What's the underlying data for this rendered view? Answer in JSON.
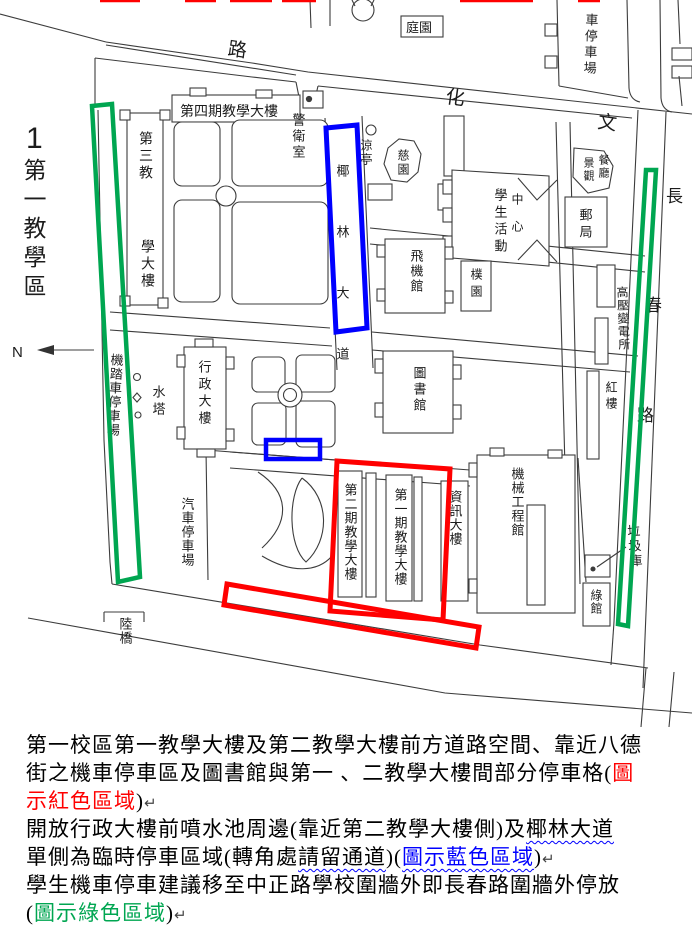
{
  "colors": {
    "overlay_red": "#ff0000",
    "overlay_blue": "#0000ff",
    "overlay_green": "#00a651",
    "map_line": "#3c3c3c",
    "note_red": "#ff0000",
    "note_blue": "#0000ff",
    "note_green": "#00a651"
  },
  "map": {
    "labels": [
      {
        "id": "area-number",
        "text": "1"
      },
      {
        "id": "area-name",
        "text": "第一教學區"
      },
      {
        "id": "north",
        "text": "N"
      },
      {
        "id": "road-wenhua-lu",
        "text": "路"
      },
      {
        "id": "road-wenhua-hua",
        "text": "化"
      },
      {
        "id": "road-wenhua-wen",
        "text": "文"
      },
      {
        "id": "road-changchun-chang",
        "text": "長"
      },
      {
        "id": "road-changchun-chun",
        "text": "春"
      },
      {
        "id": "road-changchun-lu",
        "text": "路"
      },
      {
        "id": "garden-court",
        "text": "庭園"
      },
      {
        "id": "parking-northeast",
        "text": "車停車場"
      },
      {
        "id": "teaching-bldg-4",
        "text": "第四期教學大樓"
      },
      {
        "id": "guard-room",
        "text": "警衛室"
      },
      {
        "id": "teaching-bldg-3-upper",
        "text": "第三教"
      },
      {
        "id": "teaching-bldg-3-lower",
        "text": "學大樓"
      },
      {
        "id": "pavilion",
        "text": "涼亭"
      },
      {
        "id": "ci-garden",
        "text": "慈園"
      },
      {
        "id": "yehlin-boulevard",
        "text": "椰林大道"
      },
      {
        "id": "student-activity",
        "text": "學生活動"
      },
      {
        "id": "center",
        "text": "中心"
      },
      {
        "id": "landscape",
        "text": "景觀"
      },
      {
        "id": "restaurant",
        "text": "餐廳"
      },
      {
        "id": "post-office",
        "text": "郵局"
      },
      {
        "id": "aviation-hall",
        "text": "飛機館"
      },
      {
        "id": "pu-garden",
        "text": "樸園"
      },
      {
        "id": "library",
        "text": "圖書館"
      },
      {
        "id": "hv-substation",
        "text": "高壓變電所"
      },
      {
        "id": "red-building",
        "text": "紅樓"
      },
      {
        "id": "admin-building",
        "text": "行政大樓"
      },
      {
        "id": "water-tower",
        "text": "水塔"
      },
      {
        "id": "motorcycle-parking",
        "text": "機踏車停車場"
      },
      {
        "id": "car-parking",
        "text": "汽車停車場"
      },
      {
        "id": "teaching-bldg-2",
        "text": "第二期教學大樓"
      },
      {
        "id": "teaching-bldg-1",
        "text": "第一期教學大樓"
      },
      {
        "id": "info-building",
        "text": "資訊大樓"
      },
      {
        "id": "mech-eng-hall",
        "text": "機械工程館"
      },
      {
        "id": "garbage-depot",
        "text": "垃圾庫"
      },
      {
        "id": "green-hall",
        "text": "綠館"
      },
      {
        "id": "overpass",
        "text": "陸橋"
      }
    ]
  },
  "notes": {
    "lines": [
      {
        "segments": [
          {
            "t": "第一校區第一教學大樓及第二教學大樓前方道路空間、靠近八德"
          }
        ]
      },
      {
        "segments": [
          {
            "t": "街之機車停車區及圖書館與第一 、二教學大樓間部分停車格("
          },
          {
            "t": "圖"
          }
        ]
      },
      {
        "segments": [
          {
            "t": "示紅色區域"
          },
          {
            "t": ")"
          },
          {
            "t": "↵"
          }
        ]
      },
      {
        "segments": [
          {
            "t": "開放行政大樓前噴水池周邊(靠近第二教學大樓側)及"
          },
          {
            "t": "椰林大道"
          }
        ]
      },
      {
        "segments": [
          {
            "t": "單側為臨時停車區域(轉角處"
          },
          {
            "t": "請留通道"
          },
          {
            "t": ")("
          },
          {
            "t": "圖示藍色區域"
          },
          {
            "t": ")"
          },
          {
            "t": "↵"
          }
        ]
      },
      {
        "segments": [
          {
            "t": "學生機車停車建議移至中正路學校圍牆外即長春路圍牆外停放"
          }
        ]
      },
      {
        "segments": [
          {
            "t": "("
          },
          {
            "t": "圖示綠色區域"
          },
          {
            "t": ")"
          },
          {
            "t": "↵"
          }
        ]
      }
    ]
  }
}
